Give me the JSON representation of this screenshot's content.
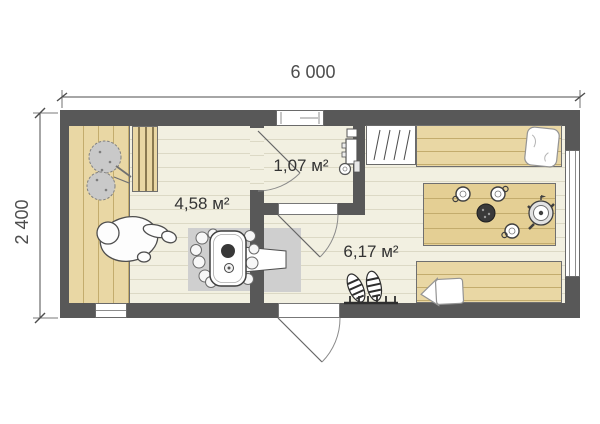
{
  "plan": {
    "title": "sauna-cabin-floor-plan",
    "dimension_labels": {
      "width": "6 000",
      "depth": "2 400"
    },
    "rooms": [
      {
        "id": "sauna",
        "area_label": "4,58 м²"
      },
      {
        "id": "washroom",
        "area_label": "1,07 м²"
      },
      {
        "id": "lounge",
        "area_label": "6,17 м²"
      }
    ],
    "colors": {
      "wall": "#585858",
      "wood": "#e9d7a4",
      "wood-line": "#c3ac6d",
      "wood-table": "#e4cf94",
      "floor": "#f2f0e1",
      "floor-line": "#dcd9c5",
      "pad": "#cfcfcf",
      "outline": "#6f6f6f",
      "dim": "#4d4d4d",
      "label": "#333333",
      "paper": "#ffffff"
    }
  }
}
